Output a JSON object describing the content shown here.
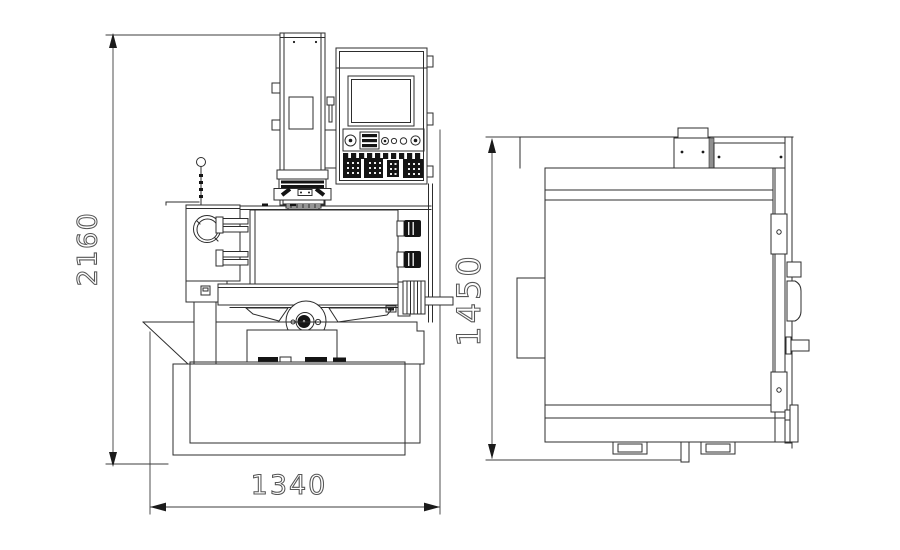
{
  "drawing": {
    "type": "machine-outline-dimension-drawing",
    "views": {
      "front": {
        "name": "front view"
      },
      "side": {
        "name": "side view"
      }
    },
    "dimensions": {
      "height": {
        "value": "2160"
      },
      "width": {
        "value": "1340"
      },
      "depth": {
        "value": "1450"
      }
    },
    "colors": {
      "background": "#ffffff",
      "line": "#2d2d2d",
      "dimension_line": "#3c3c3c",
      "dimension_text": "#565656",
      "dark_fill": "#141414"
    }
  }
}
